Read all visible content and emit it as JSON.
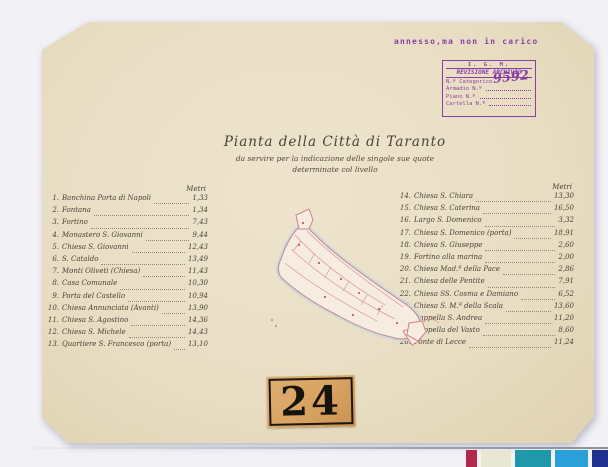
{
  "note": "annesso,ma non in carico",
  "stamp": {
    "org": "I. G. M.",
    "title": "REVISIONE ARCHIVIO",
    "category_label": "N.º Categorico",
    "category_value": "9592",
    "fields": [
      {
        "label": "Armadio",
        "no": "N.º"
      },
      {
        "label": "Piano",
        "no": "N.º"
      },
      {
        "label": "Cartella",
        "no": "N.º"
      }
    ]
  },
  "title": {
    "main": "Pianta della Città di Taranto",
    "sub1": "da servire per la indicazione delle singole sue quote",
    "sub2": "determinate col livello"
  },
  "left_list": {
    "header": "Metri",
    "items": [
      {
        "n": "1.",
        "name": "Banchina Porta di Napoli",
        "value": "1,33"
      },
      {
        "n": "2.",
        "name": "Fontana",
        "value": "1,34"
      },
      {
        "n": "3.",
        "name": "Fortino",
        "value": "7,43"
      },
      {
        "n": "4.",
        "name": "Monastero S. Giovanni",
        "value": "9,44"
      },
      {
        "n": "5.",
        "name": "Chiesa S. Giovanni",
        "value": "12,43"
      },
      {
        "n": "6.",
        "name": "S. Cataldo",
        "value": "13,49"
      },
      {
        "n": "7.",
        "name": "Monti Oliveti (Chiesa)",
        "value": "11,43"
      },
      {
        "n": "8.",
        "name": "Casa Comunale",
        "value": "10,30"
      },
      {
        "n": "9.",
        "name": "Porta del Castello",
        "value": "10,94"
      },
      {
        "n": "10.",
        "name": "Chiesa Annunciata (Avanti)",
        "value": "13,90"
      },
      {
        "n": "11.",
        "name": "Chiesa S. Agostino",
        "value": "14,36"
      },
      {
        "n": "12.",
        "name": "Chiesa S. Michele",
        "value": "14,43"
      },
      {
        "n": "13.",
        "name": "Quartiere S. Francesco (porta)",
        "value": "13,10"
      }
    ]
  },
  "right_list": {
    "header": "Metri",
    "items": [
      {
        "n": "14.",
        "name": "Chiesa S. Chiara",
        "value": "13,30"
      },
      {
        "n": "15.",
        "name": "Chiesa S. Caterina",
        "value": "16,50"
      },
      {
        "n": "16.",
        "name": "Largo S. Domenico",
        "value": "3,32"
      },
      {
        "n": "17.",
        "name": "Chiesa S. Domenico (porta)",
        "value": "18,91"
      },
      {
        "n": "18.",
        "name": "Chiesa S. Giuseppe",
        "value": "2,60"
      },
      {
        "n": "19.",
        "name": "Fortino alla marina",
        "value": "2,00"
      },
      {
        "n": "20.",
        "name": "Chiesa Mad.ª della Pace",
        "value": "2,86"
      },
      {
        "n": "21.",
        "name": "Chiesa delle Pentite",
        "value": "7,91"
      },
      {
        "n": "22.",
        "name": "Chiesa SS. Cosma e Damiano",
        "value": "6,52"
      },
      {
        "n": "23.",
        "name": "Chiesa S. M.ª della Scala",
        "value": "13,60"
      },
      {
        "n": "24.",
        "name": "Cappella S. Andrea",
        "value": "11,20"
      },
      {
        "n": "25.",
        "name": "Cappella del Vasto",
        "value": "8,60"
      },
      {
        "n": "26.",
        "name": "Ponte di Lecce",
        "value": "11,24"
      }
    ]
  },
  "plate_number": "24",
  "colors": {
    "stamp_purple": "#8a3fa8",
    "ink": "#4a4238",
    "paper": "#e9dec4",
    "label_tan": "#d8a262",
    "map_line": "#cf8383",
    "map_water": "#c3d9e5",
    "background": "#f2f1f6"
  },
  "color_bar": [
    "#b4294b",
    "#e9e6d3",
    "#1f98a9",
    "#2ba0d8",
    "#20308f"
  ]
}
